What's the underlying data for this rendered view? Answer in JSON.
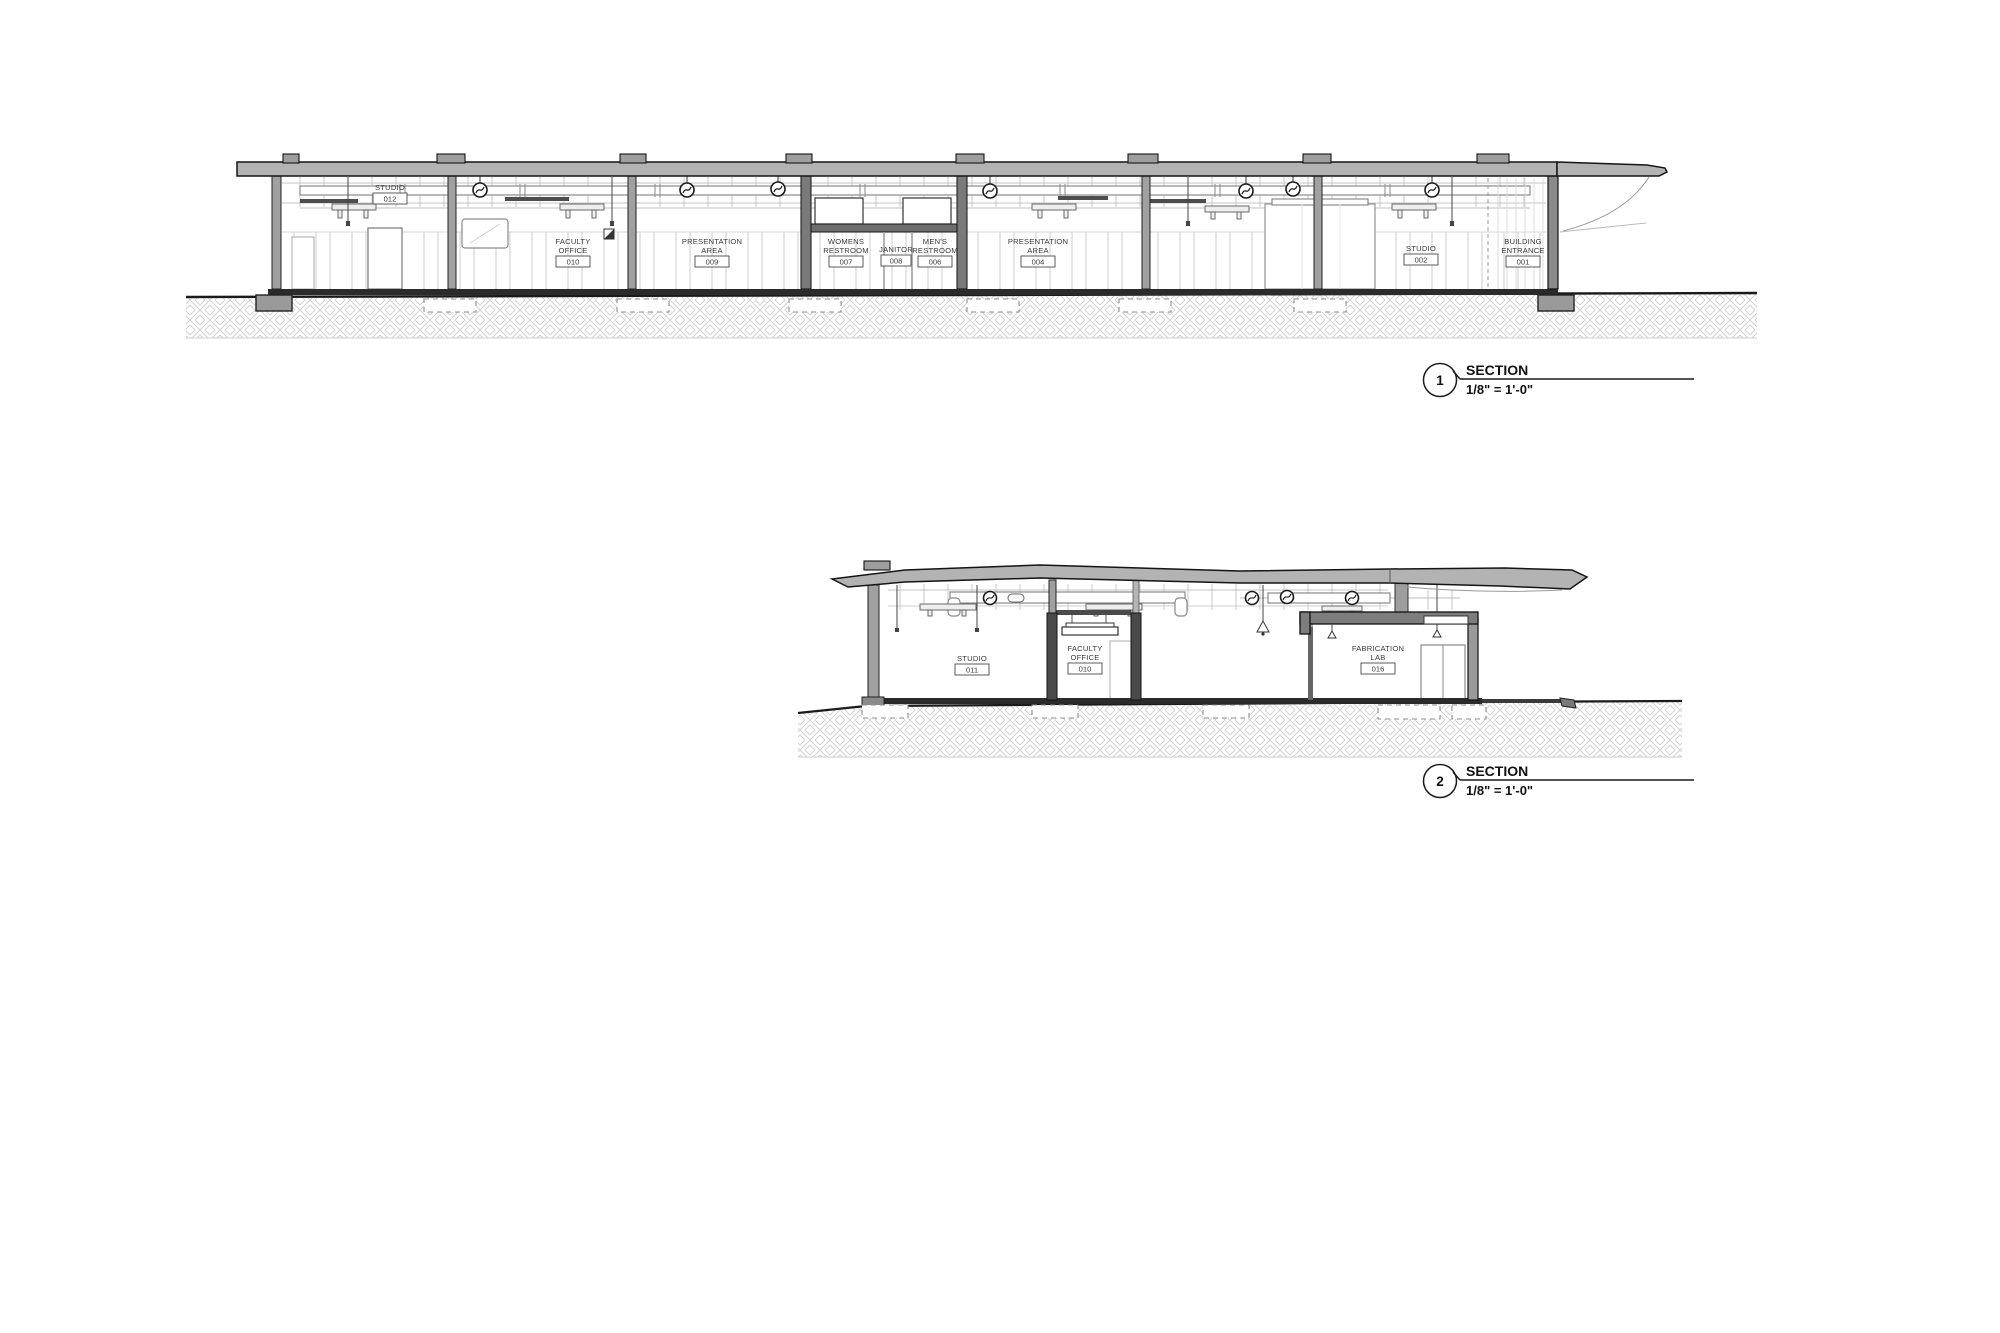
{
  "section1": {
    "callout": {
      "number": "1",
      "title": "SECTION",
      "scale": "1/8\" = 1'-0\""
    },
    "rooms": [
      {
        "l1": "STUDIO",
        "l2": "",
        "num": "012"
      },
      {
        "l1": "FACULTY",
        "l2": "OFFICE",
        "num": "010"
      },
      {
        "l1": "PRESENTATION",
        "l2": "AREA",
        "num": "009"
      },
      {
        "l1": "WOMENS",
        "l2": "RESTROOM",
        "num": "007"
      },
      {
        "l1": "JANITOR",
        "l2": "",
        "num": "008"
      },
      {
        "l1": "MEN'S",
        "l2": "RESTROOM",
        "num": "006"
      },
      {
        "l1": "PRESENTATION",
        "l2": "AREA",
        "num": "004"
      },
      {
        "l1": "STUDIO",
        "l2": "",
        "num": "002"
      },
      {
        "l1": "BUILDING",
        "l2": "ENTRANCE",
        "num": "001"
      }
    ]
  },
  "section2": {
    "callout": {
      "number": "2",
      "title": "SECTION",
      "scale": "1/8\" = 1'-0\""
    },
    "rooms": [
      {
        "l1": "STUDIO",
        "l2": "",
        "num": "011"
      },
      {
        "l1": "FACULTY",
        "l2": "OFFICE",
        "num": "010"
      },
      {
        "l1": "FABRICATION",
        "l2": "LAB",
        "num": "016"
      }
    ]
  }
}
